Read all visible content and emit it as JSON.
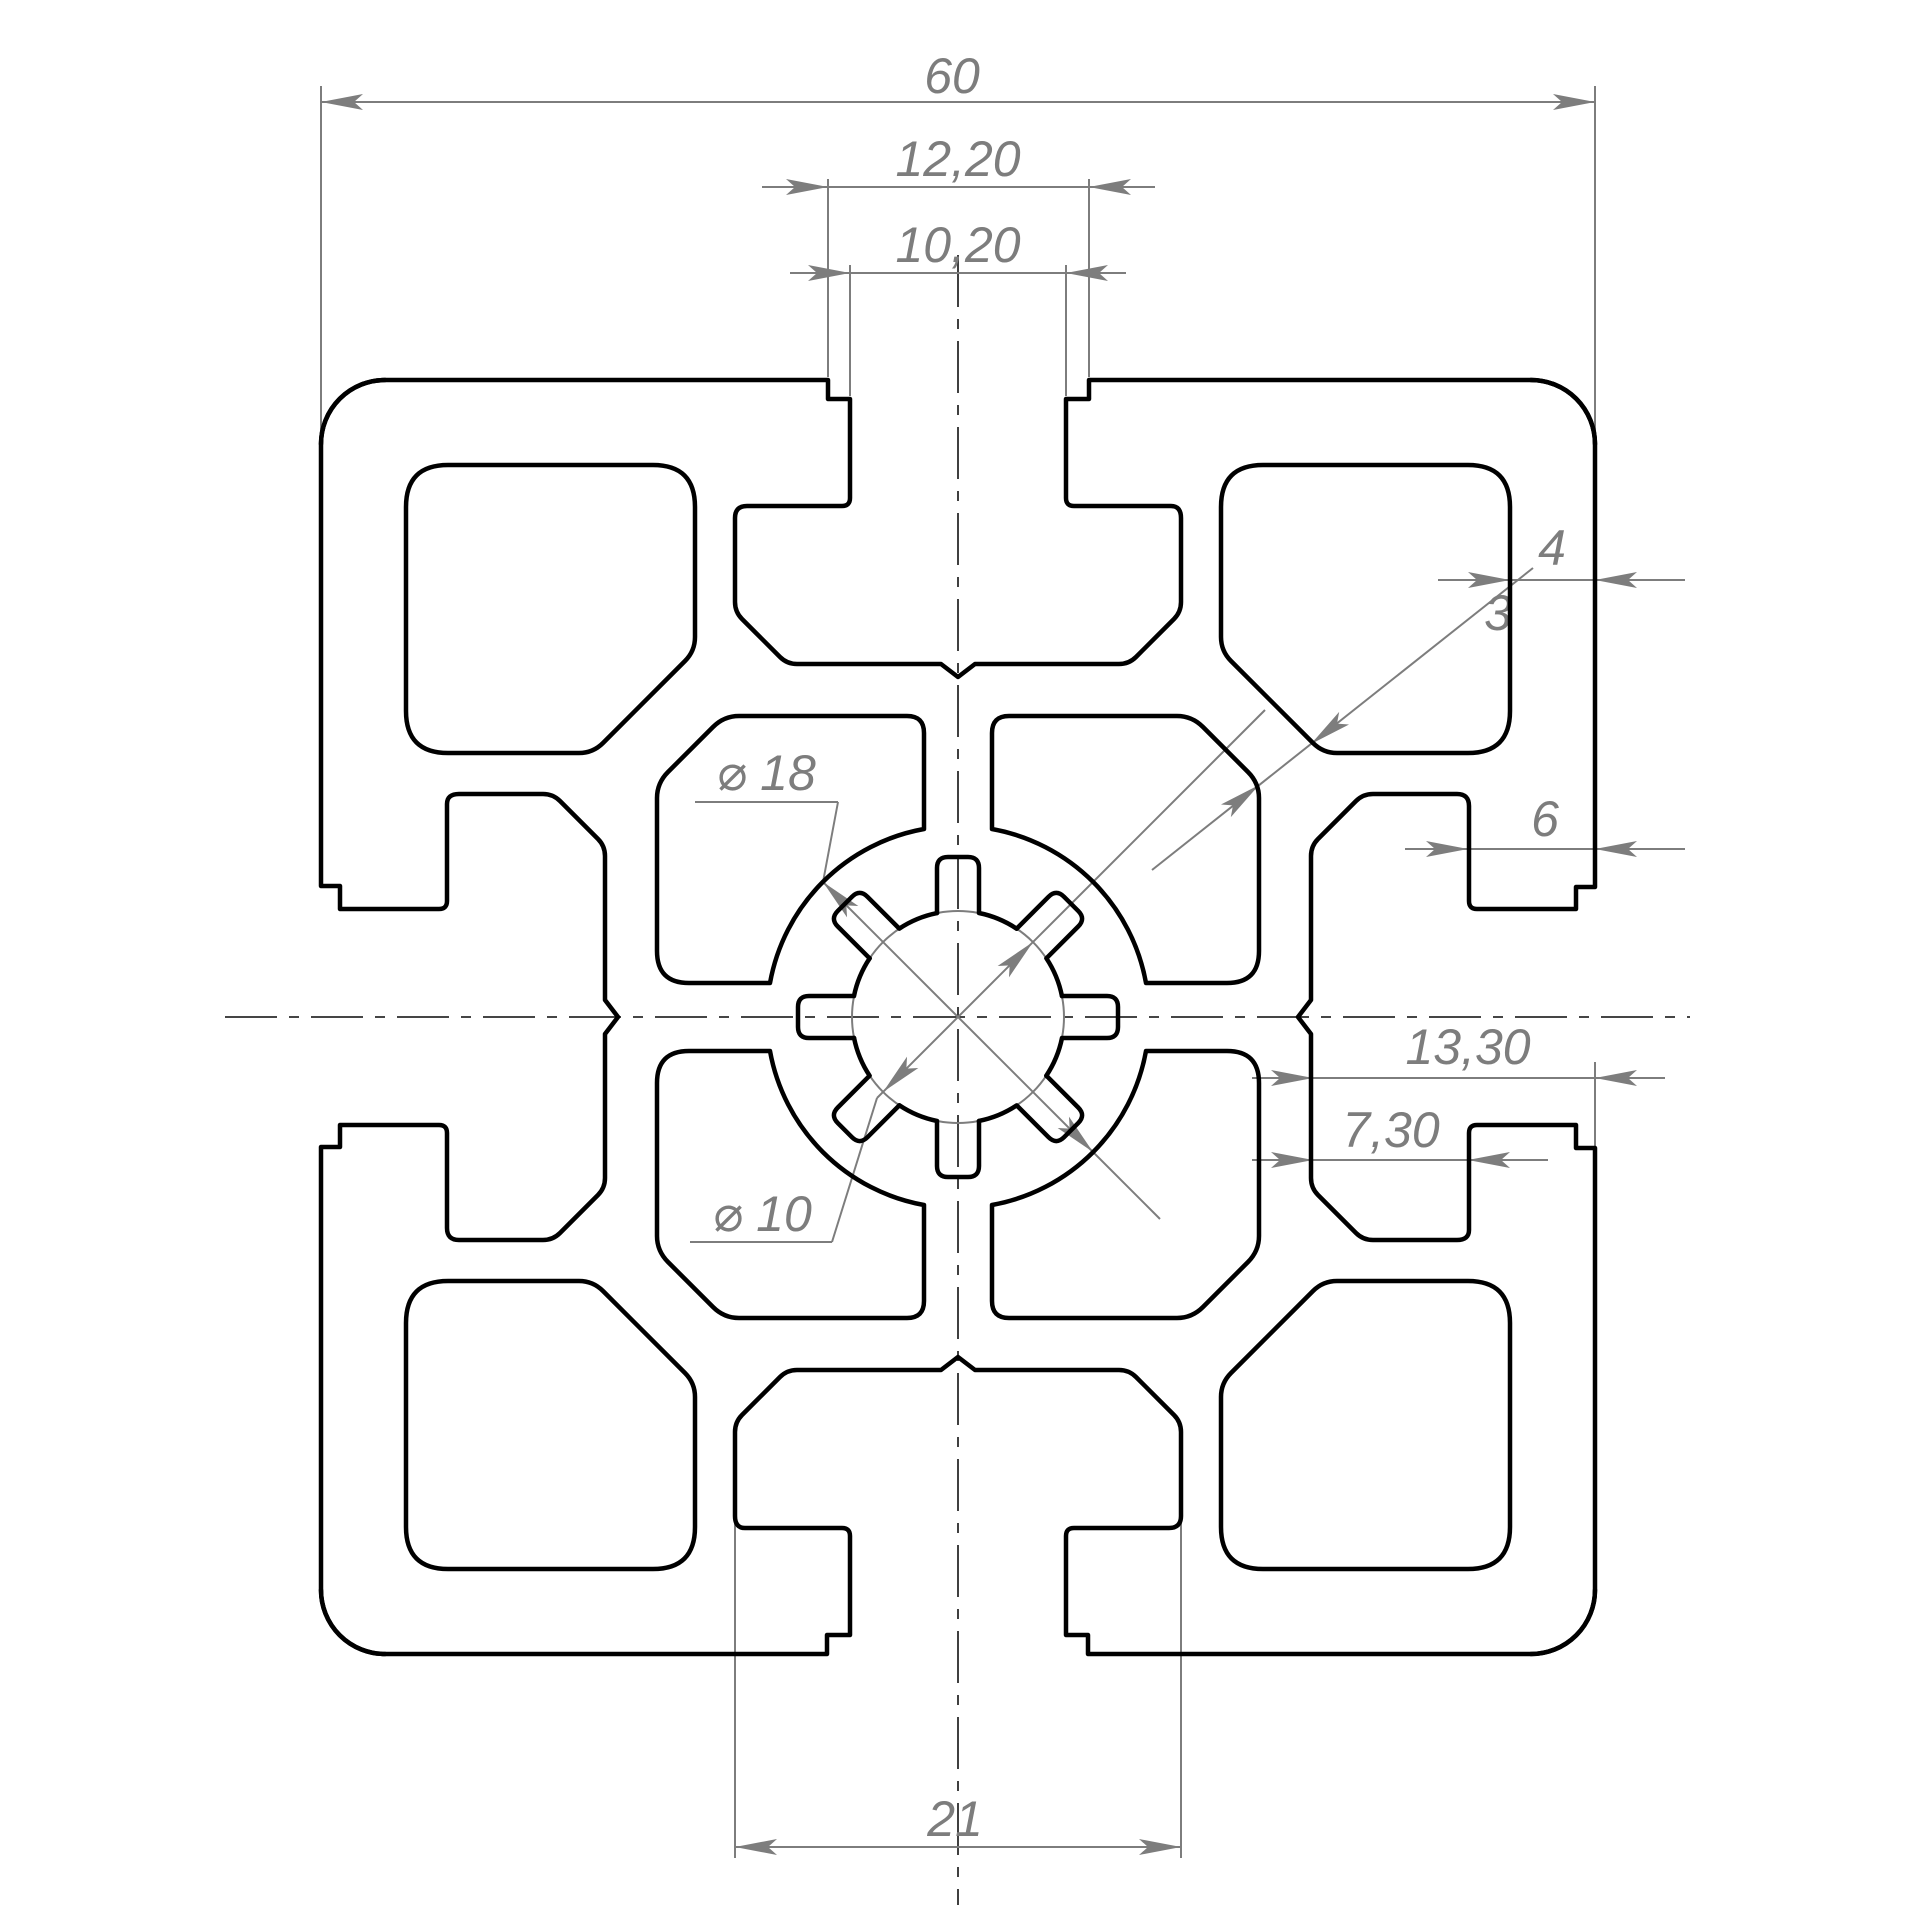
{
  "drawing": {
    "type": "technical-cross-section",
    "subject": "aluminium T-slot extrusion profile",
    "dimensions": {
      "overall_width": "60",
      "slot_opening_outer": "12,20",
      "slot_opening_inner": "10,20",
      "outer_wall_thickness": "4",
      "diagonal_web_thickness": "3",
      "flange_depth": "6",
      "core_outer_diameter": "⌀ 18",
      "core_bore_diameter": "⌀ 10",
      "slot_total_depth": "13,30",
      "slot_cavity_height": "7,30",
      "slot_cavity_width": "21"
    },
    "colors": {
      "outline": "#000000",
      "annotation": "#7d7d7d",
      "centerline": "#2b2b2b",
      "background": "#ffffff"
    }
  }
}
